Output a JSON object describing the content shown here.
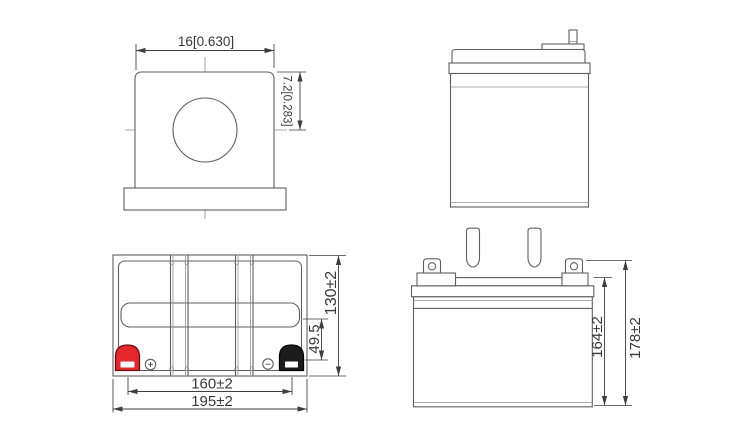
{
  "drawing": {
    "colors": {
      "background": "#ffffff",
      "line": "#5f5f5f",
      "dimension": "#3d3d3d",
      "positive_terminal": "#e5262b",
      "negative_terminal": "#1c1c1c"
    },
    "terminal_detail_view": {
      "width": "16[0.630]",
      "height": "7.2[0.283]"
    },
    "top_view": {
      "terminal_spacing": "160±2",
      "overall_width": "195±2",
      "overall_depth": "130±2",
      "terminal_offset": "49.5",
      "positive_mark": "+",
      "negative_mark": "−"
    },
    "front_view": {
      "case_height": "164±2",
      "overall_height": "178±2"
    }
  }
}
